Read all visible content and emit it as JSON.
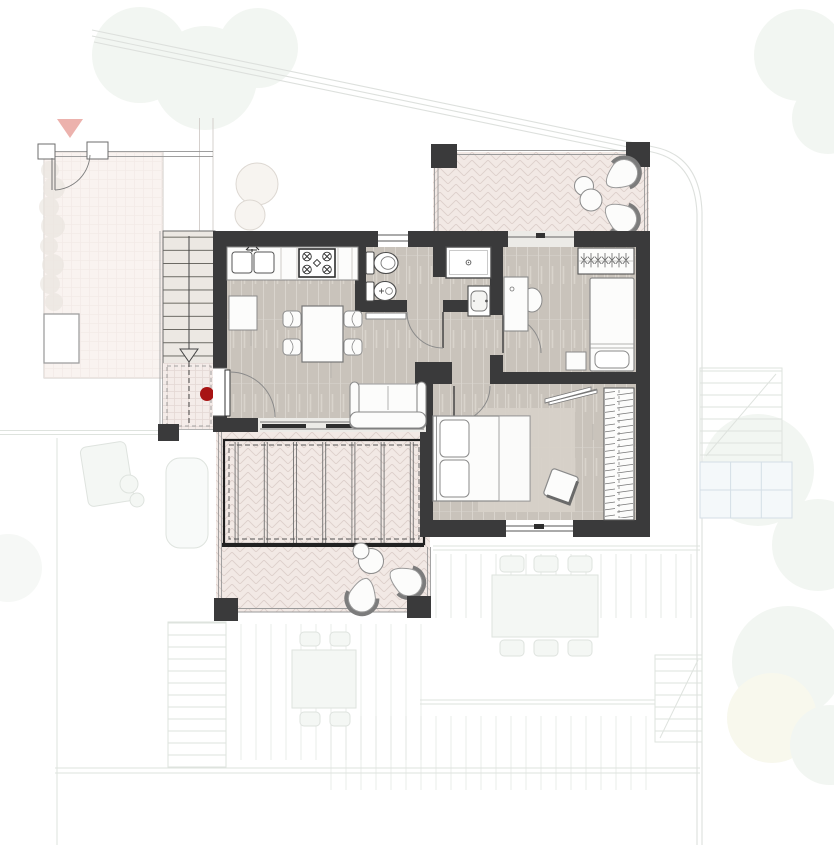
{
  "palette": {
    "wall": "#3a3a3b",
    "floor": "#c9c3bb",
    "floor-line": "#d9d4cd",
    "terrace": "#f2e9e5",
    "terrace-line": "#ddd0cb",
    "landing": "#f4ece9",
    "landing-line": "#e4d8d4",
    "stair-fill": "#ece8e3",
    "furniture-fill": "#fcfcfb",
    "furniture-stroke": "#8c8c8c",
    "fixture-stroke": "#4a4a4a",
    "rug": "#d7d1c8",
    "entry-dot": "#a81414",
    "direction-marker": "#e9a59f",
    "faint-stroke": "#d9ded9",
    "faint-fill": "#f2f6f3",
    "tree": "#e6ede4",
    "rail": "#9a9a9a",
    "glass": "#ecebe7"
  },
  "markers": {
    "entry_dot_color": "#a81414",
    "direction_triangle_color": "#e9a59f"
  },
  "plan": {
    "rooms": [
      {
        "id": "living-kitchen",
        "furniture": [
          "kitchen-counter",
          "double-sink",
          "cooktop-4-burner",
          "base-cabinet",
          "dining-table",
          "dining-chair-x4",
          "sofa"
        ]
      },
      {
        "id": "bathroom",
        "furniture": [
          "toilet",
          "bidet",
          "shower",
          "washbasin",
          "shelf"
        ]
      },
      {
        "id": "hallway",
        "furniture": []
      },
      {
        "id": "bedroom-1",
        "furniture": [
          "desk",
          "desk-chair",
          "wardrobe-hangers",
          "single-bed",
          "pillow",
          "nightstand"
        ]
      },
      {
        "id": "bedroom-2",
        "furniture": [
          "double-bed",
          "pillow-x2",
          "rug",
          "pouf",
          "wardrobe-hangers",
          "lean-shelf"
        ]
      },
      {
        "id": "terrace-top",
        "furniture": [
          "lounge-chair-x2",
          "side-table-x2"
        ]
      },
      {
        "id": "terrace-bottom",
        "furniture": [
          "pergola-slats",
          "lounge-chair-x2",
          "side-table",
          "round-table"
        ]
      },
      {
        "id": "staircase",
        "furniture": [
          "treads",
          "direction-arrow",
          "tiled-landing",
          "entry-dot-marker",
          "column"
        ]
      },
      {
        "id": "front-yard",
        "furniture": [
          "planter",
          "gate",
          "fence",
          "hedge",
          "direction-triangle-marker"
        ]
      }
    ]
  }
}
